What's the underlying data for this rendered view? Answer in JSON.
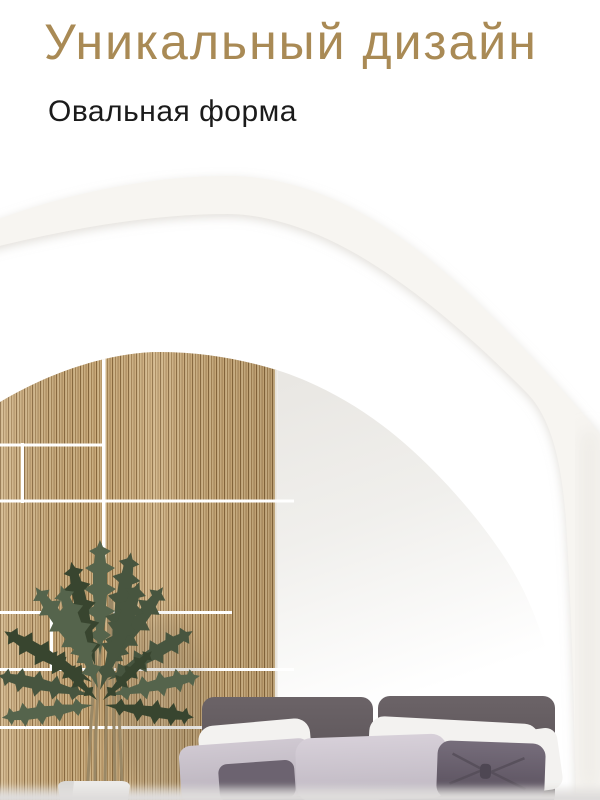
{
  "header": {
    "title": "Уникальный дизайн",
    "subtitle": "Овальная форма"
  },
  "colors": {
    "title-gold": "#a98a55",
    "subtitle-ink": "#1b1b1b",
    "page-bg": "#ffffff",
    "frame-white": "#f7f5f1",
    "wood-base": "#c4a474",
    "grid-line": "#ffffff",
    "reflection-gray": "#e9e7e3",
    "plant-green": "#47553f",
    "stem-tan": "#9a8866",
    "pot-white": "#ecebe9",
    "headboard-plum": "#625a5f",
    "pillow-white": "#f3f2f0",
    "pillow-lavender": "#ccc5ce",
    "cushion-plum": "#6c6370",
    "bottom-haze": "#dedcdc"
  }
}
